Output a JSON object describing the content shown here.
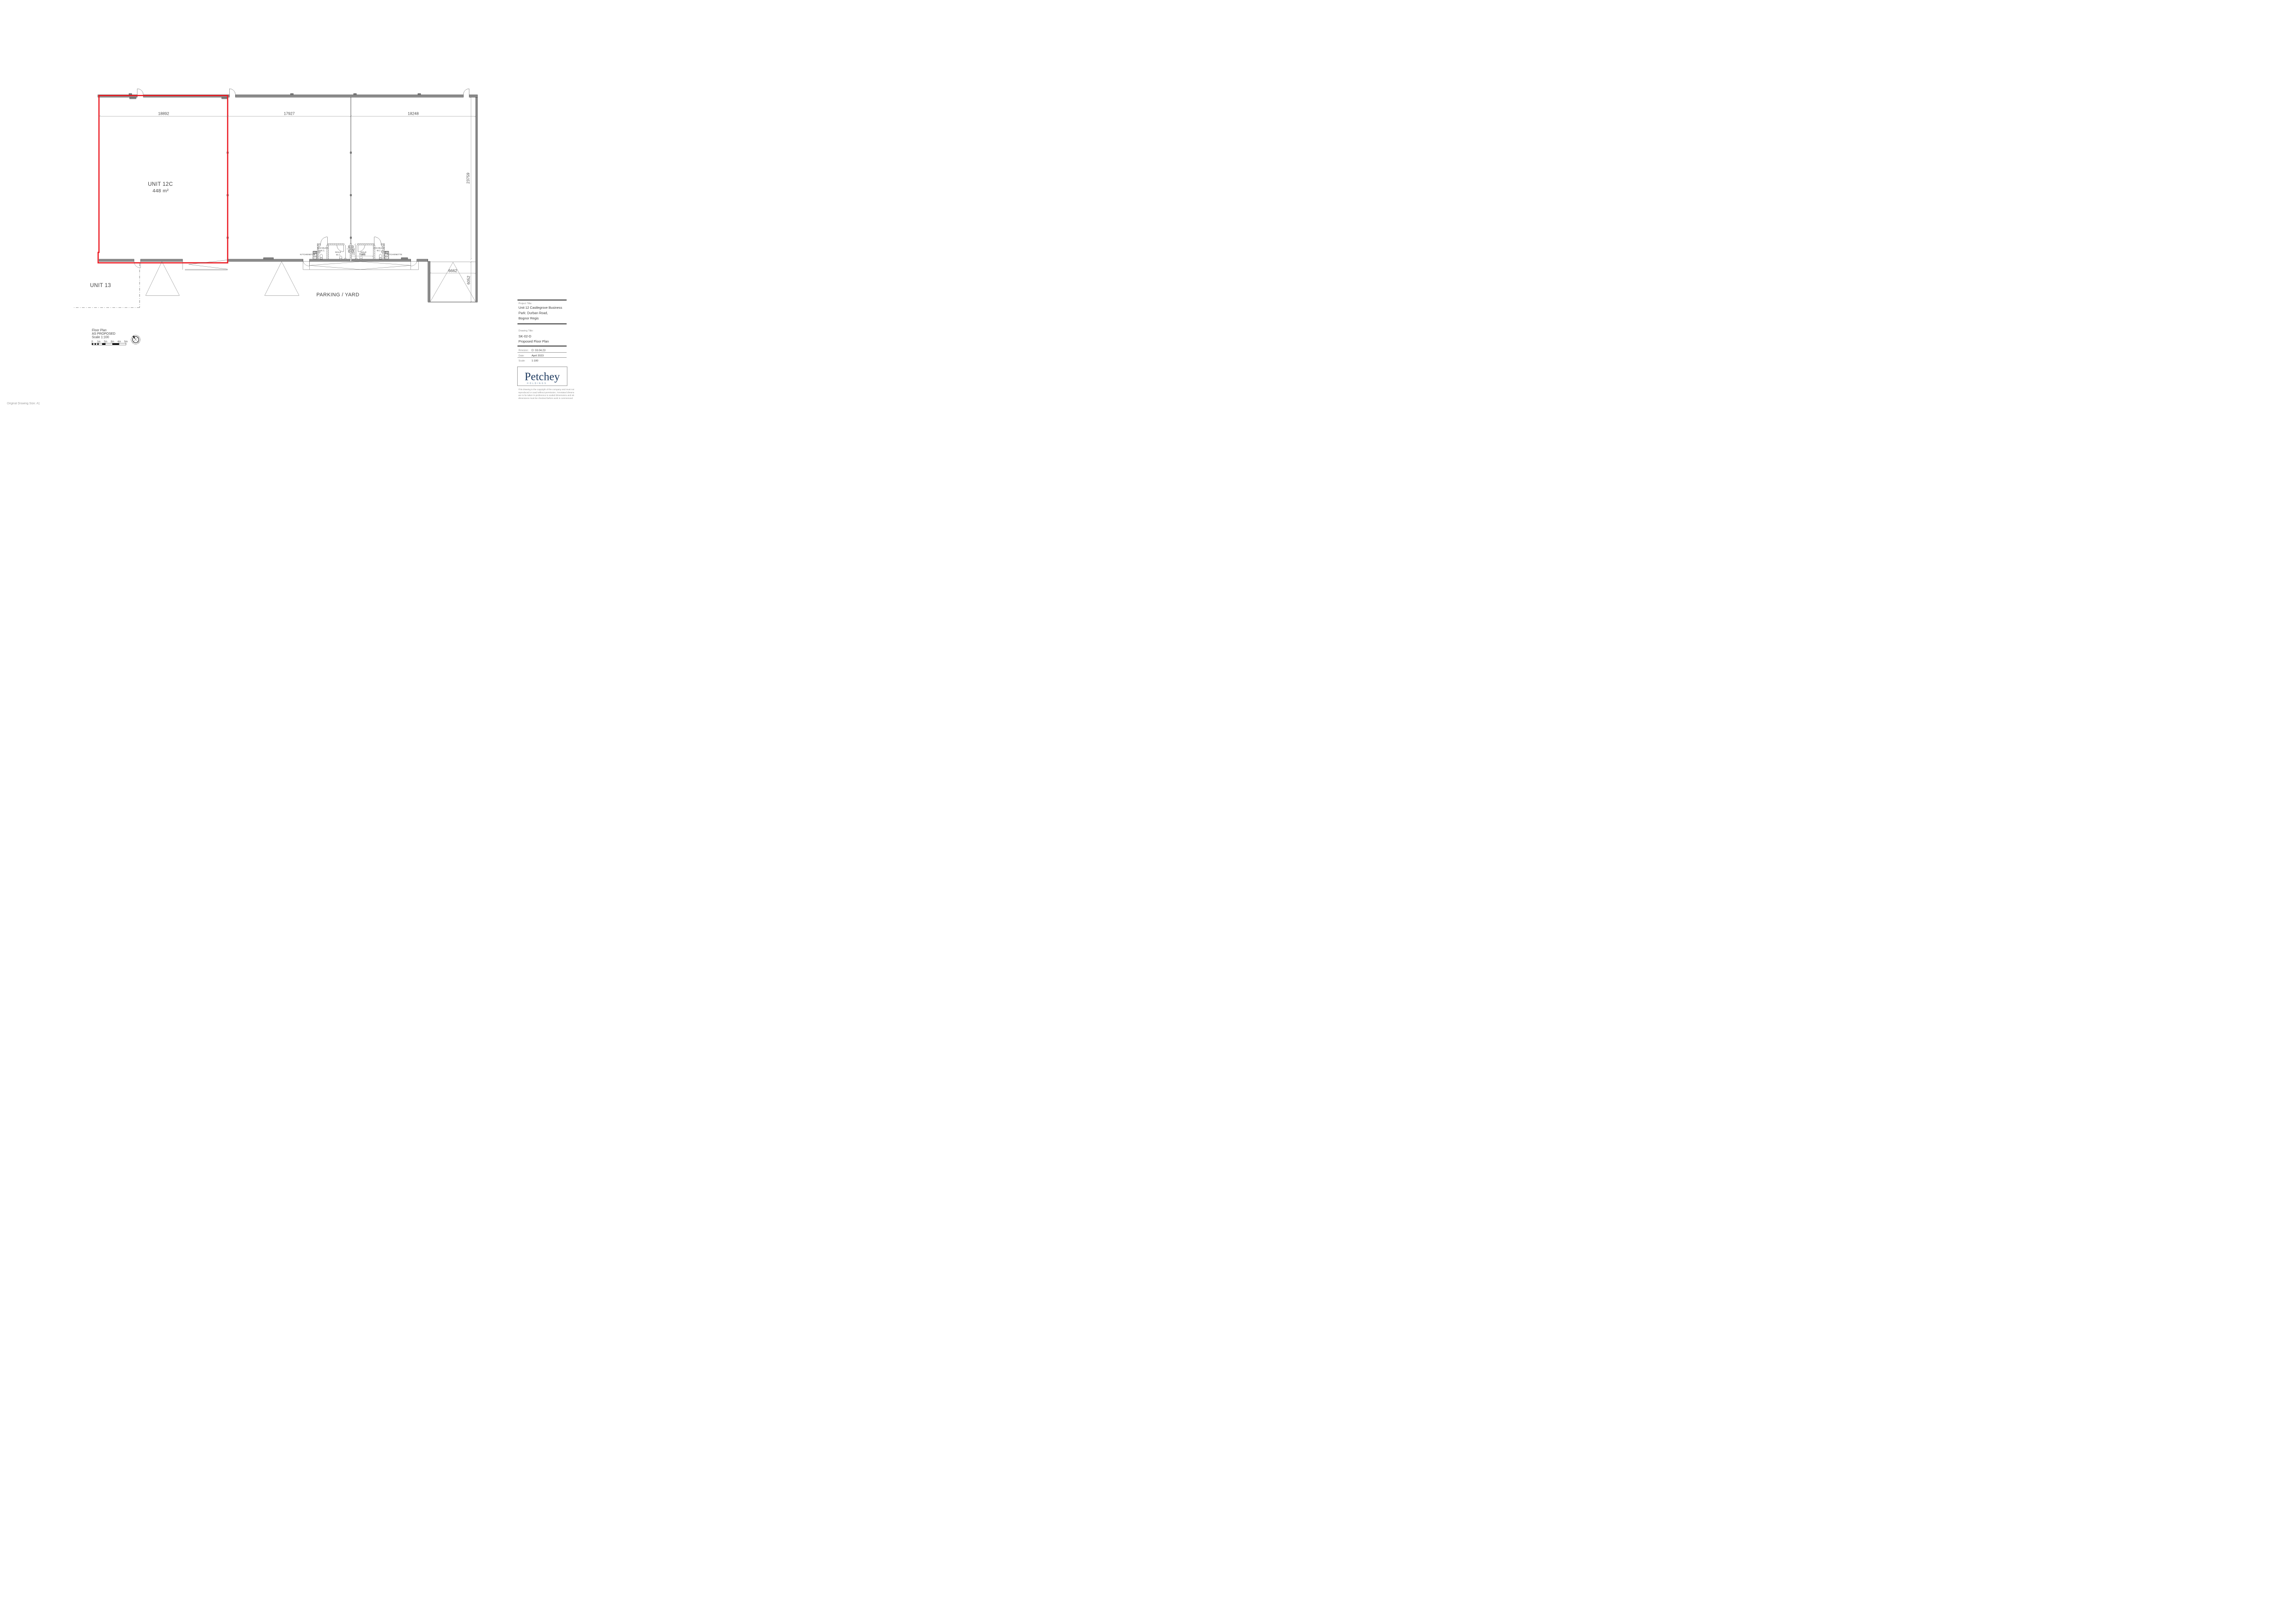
{
  "colors": {
    "red": "#ec1c24",
    "wall_gray": "#8c8c8c",
    "line_dark": "#2b2b2b",
    "dim_gray": "#6e6e6e",
    "navy": "#1e3a5f"
  },
  "plan": {
    "units": {
      "unit12c_name": "UNIT 12C",
      "unit12c_area": "448 m²",
      "unit13": "UNIT 13",
      "parking": "PARKING / YARD"
    },
    "rooms": {
      "kitchenette_left": "KITCHENETTE",
      "kitchenette_right": "KITCHENETTE",
      "disabled_left_l1": "DISABLED",
      "disabled_left_l2": "W.C.",
      "disabled_right_l1": "DISABLED",
      "disabled_right_l2": "W.C.",
      "male_left_l1": "MALE",
      "male_left_l2": "W.C",
      "male_right_l1": "MALE",
      "male_right_l2": "W.C"
    },
    "dims": {
      "top_left": "18892",
      "top_mid": "17927",
      "top_right": "18248",
      "right_height": "23759",
      "bay_width": "6662",
      "bay_depth": "6052",
      "wc_depth": "2200",
      "wc_width": "3180"
    }
  },
  "legend": {
    "line1": "Floor Plan",
    "line2": "AS PROPOSED",
    "line3": "Scale 1:100",
    "scale_ticks": [
      "0",
      "1m",
      "2m",
      "3m",
      "4m",
      "5m"
    ]
  },
  "title_block": {
    "project_title_label": "Project Title:",
    "project_title": [
      "Unit 12 Castlegrove Business",
      "Park: Durban Road,",
      "Bognor Regis"
    ],
    "drawing_title_label": "Drawing Title:",
    "drawing_code": "SK-02-D",
    "drawing_title": "Proposed Floor Plan",
    "revision_label": "Revision:",
    "revision_value": "D: 03.04.23",
    "date_label": "Date:",
    "date_value": "April 2023",
    "scale_label": "Scale:",
    "scale_value": "1:100",
    "logo_main": "Petchey",
    "logo_sub": "HOLDINGS",
    "disclaimer": [
      "This drawing is the copyright of the company and must not be",
      "reproduced or used without permission. Annotated dimensions",
      "are to be taken in preference to scaled dimensions and site",
      "dimensions must be checked before work is commenced"
    ]
  },
  "footnote": "Original Drawing Size: A1"
}
